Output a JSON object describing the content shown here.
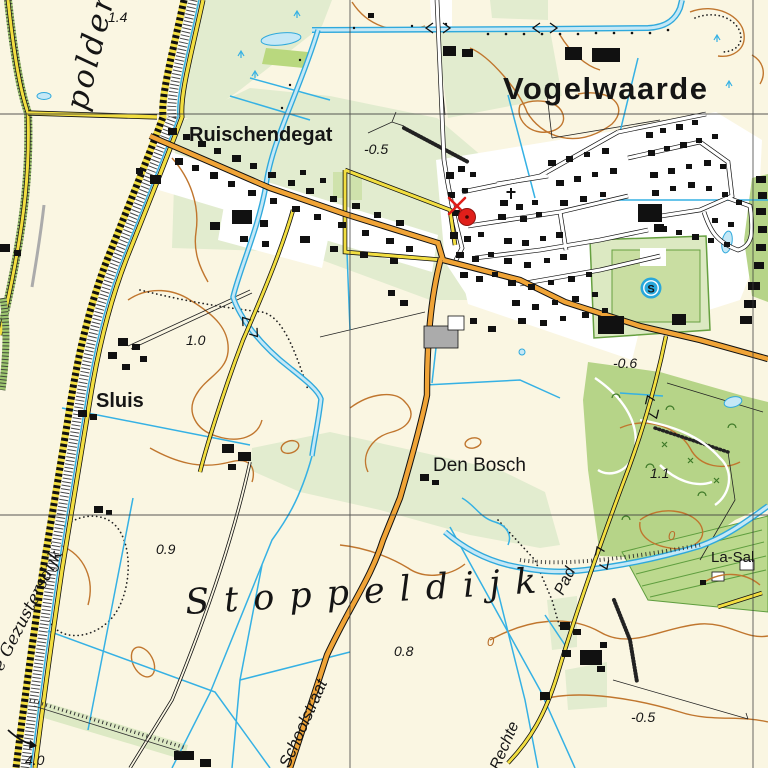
{
  "map": {
    "place_labels": {
      "town": "Vogelwaarde",
      "hamlet_ruischendegat": "Ruischendegat",
      "hamlet_sluis": "Sluis",
      "locality_den_bosch": "Den Bosch",
      "polder_stoppeldijk": "Stoppeldijk",
      "polder_partial": "polder",
      "dike_gezustersdijk": "e Gezustersdijk",
      "estate_la_salette": "La-Sal"
    },
    "street_labels": {
      "schoolstraat": "Schoolstraat",
      "rechte": "Rechte",
      "pad": "Pad"
    },
    "spot_heights": [
      {
        "value": "1.4"
      },
      {
        "value": "-0.5"
      },
      {
        "value": "1.0"
      },
      {
        "value": "0.9"
      },
      {
        "value": "-0.6"
      },
      {
        "value": "1.1"
      },
      {
        "value": "0.8"
      },
      {
        "value": "-0.5"
      },
      {
        "value": "4.0"
      }
    ],
    "contour_labels": [
      {
        "value": "0"
      },
      {
        "value": "0"
      }
    ],
    "symbols": {
      "sports_field_letter": "S"
    },
    "colors": {
      "background": "#FAF6E2",
      "field_green": "#E2ECCF",
      "park_green": "#B6D488",
      "water_blue": "#35B1E4",
      "water_fill": "#C5E8F6",
      "main_road_orange": "#F0A437",
      "local_road_yellow": "#F2DE41",
      "contour_brown": "#C0762E",
      "marker_red": "#E01F1A",
      "sports_symbol_blue": "#29A7DB"
    }
  }
}
